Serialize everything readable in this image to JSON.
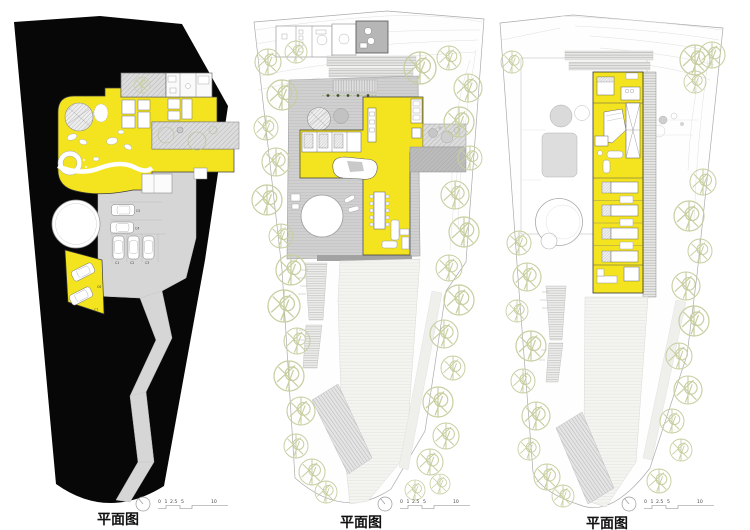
{
  "colors": {
    "highlight_yellow": "#F3E41F",
    "site_black": "#070707",
    "deck_gray": "#D0D0D0",
    "tree_outline_green": "#C8CEA0"
  },
  "icons": {
    "north_arrow": "north-arrow-icon"
  },
  "scale_bar": {
    "labels": [
      "0",
      "1",
      "2.5",
      "5",
      "10"
    ]
  },
  "panels": [
    {
      "caption": "平面图",
      "car_labels": [
        "C1",
        "C2",
        "C3",
        "C4",
        "C5",
        "C6",
        "C7"
      ]
    },
    {
      "caption": "平面图"
    },
    {
      "caption": "平面图"
    }
  ]
}
